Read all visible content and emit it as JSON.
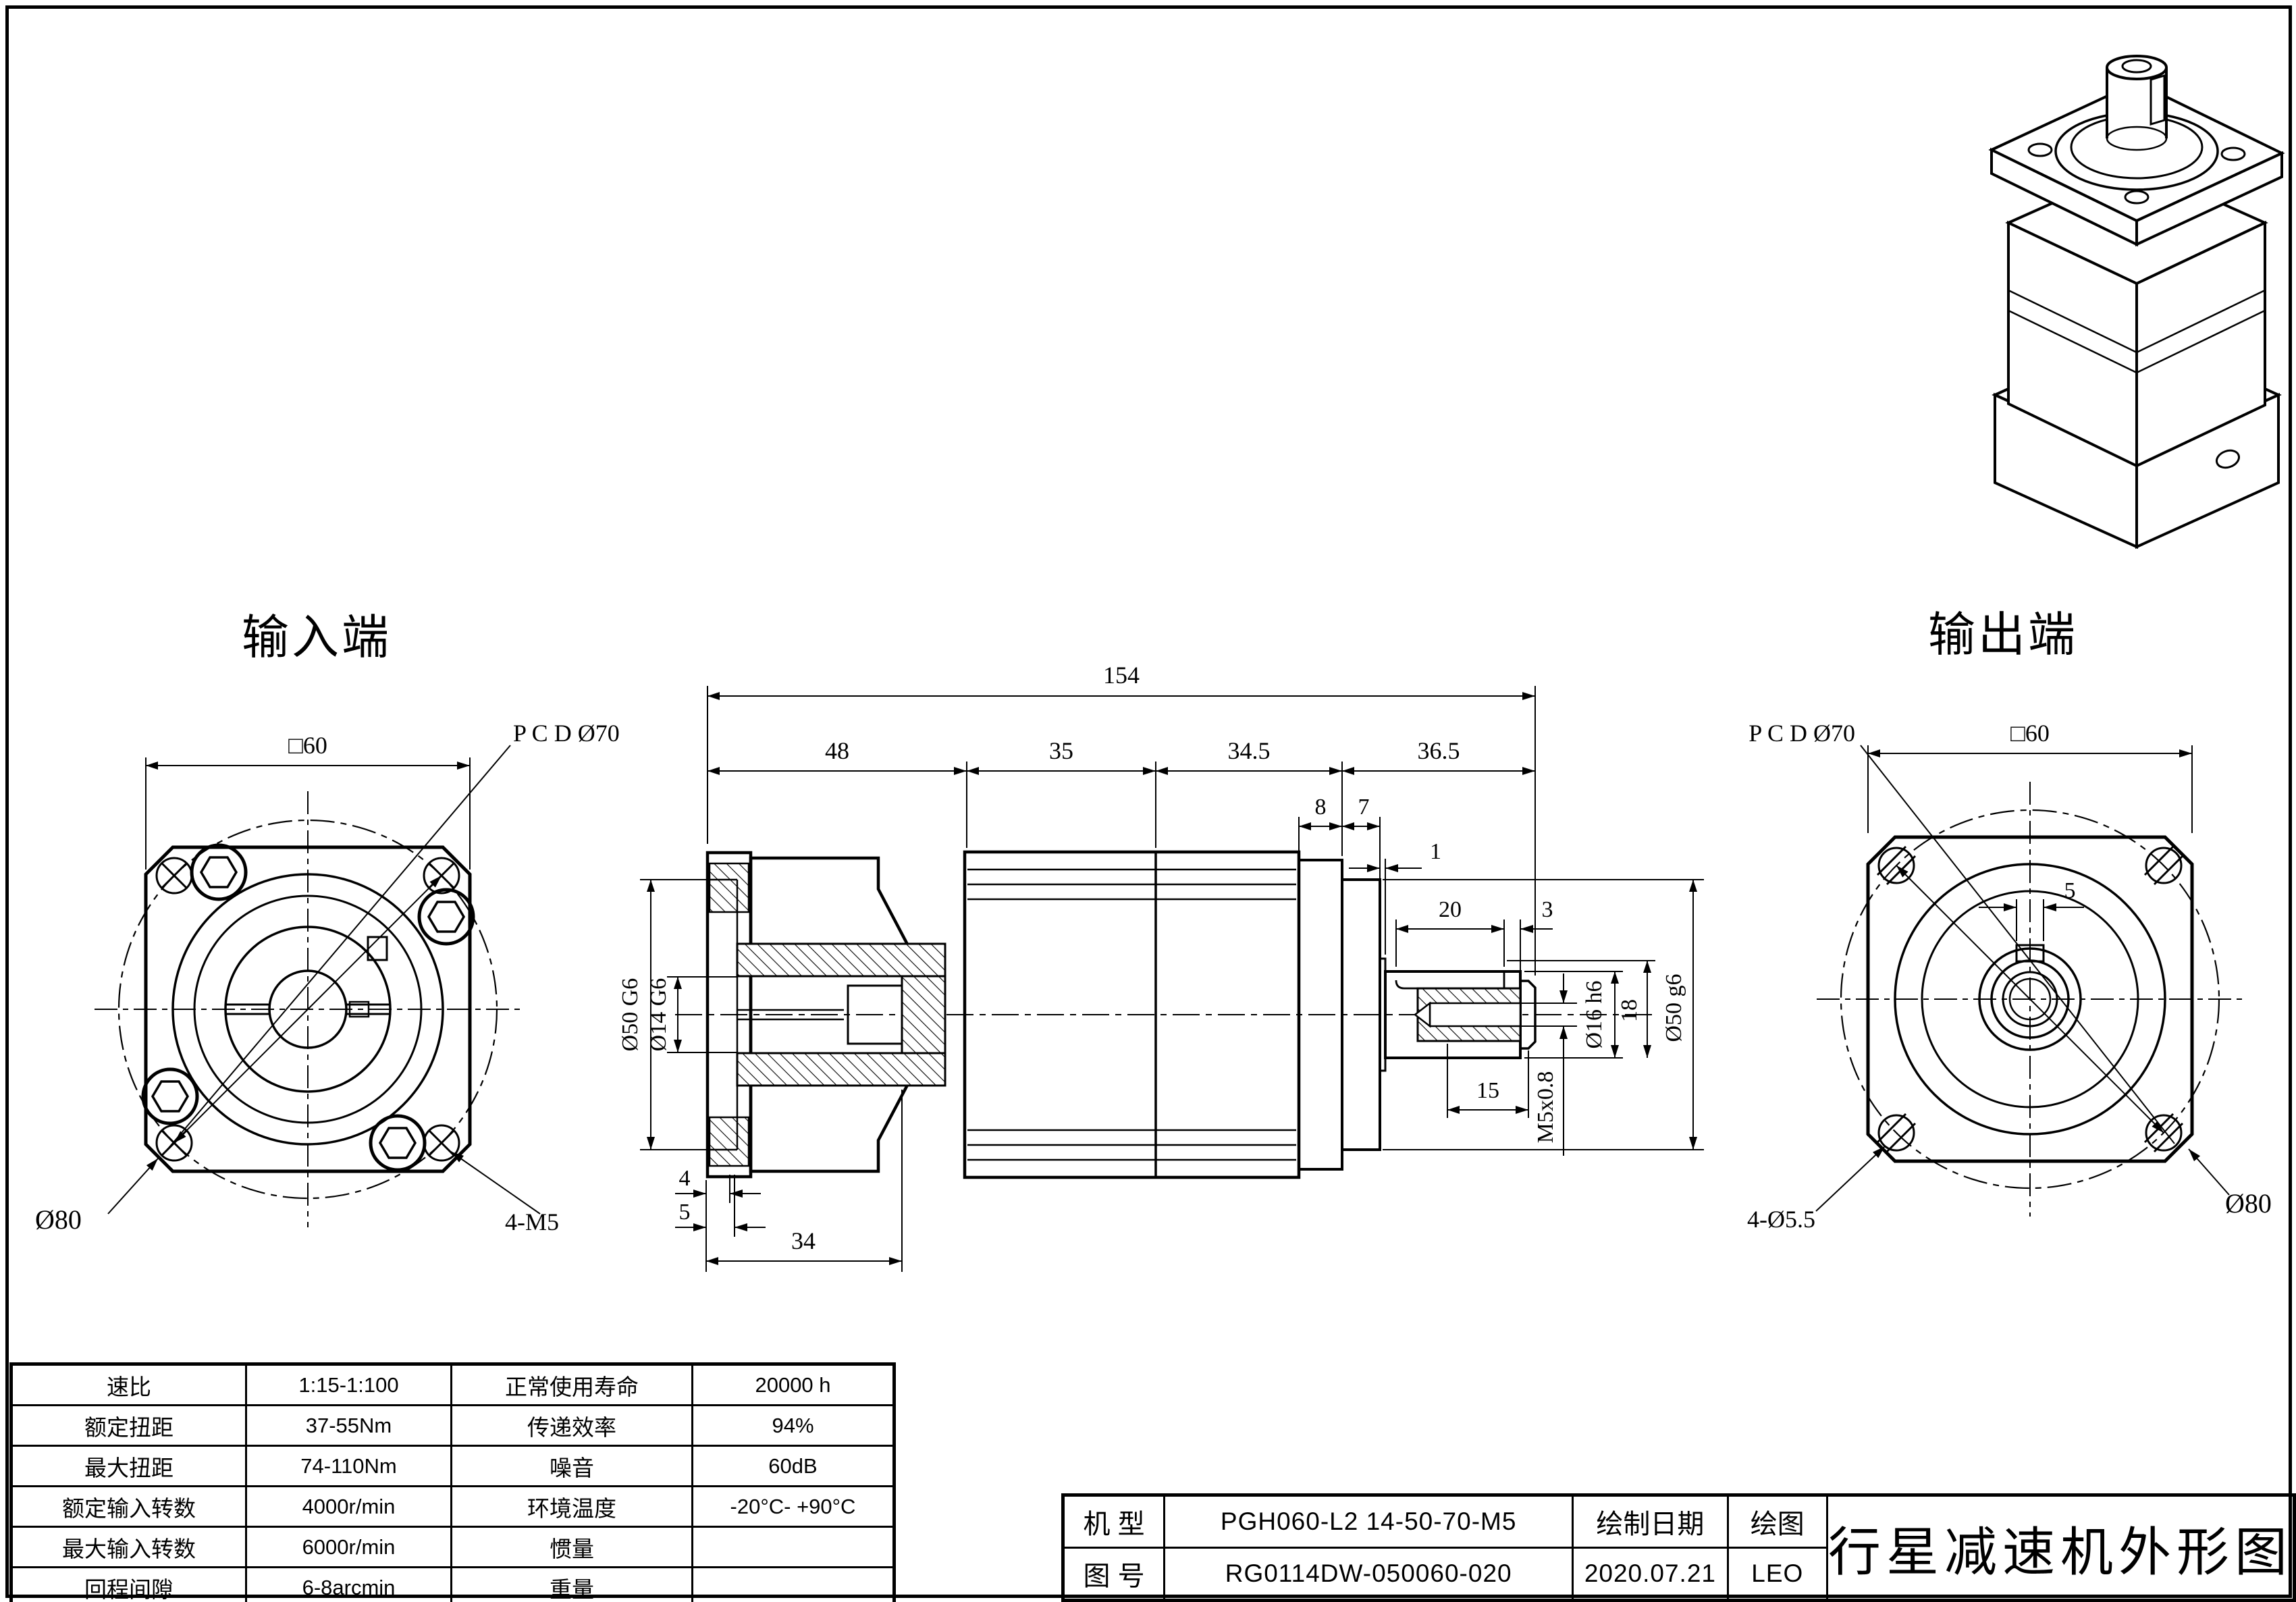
{
  "labels": {
    "input_end": "输入端",
    "output_end": "输出端"
  },
  "input_view": {
    "square": "□60",
    "pcd": "P C D Ø70",
    "outer_dia": "Ø80",
    "holes": "4-M5"
  },
  "section_view": {
    "total_len": "154",
    "seg_48": "48",
    "seg_35": "35",
    "seg_34_5": "34.5",
    "seg_36_5": "36.5",
    "d8": "8",
    "d7": "7",
    "d1": "1",
    "front_spigot": "Ø50 G6",
    "input_bore": "Ø14 G6",
    "d4": "4",
    "d5": "5",
    "d34": "34",
    "key_len": "20",
    "d3": "3",
    "thread_depth": "15",
    "thread": "M5x0.8",
    "shaft_dia": "Ø16 h6",
    "d18": "18",
    "rear_spigot": "Ø50 g6"
  },
  "output_view": {
    "square": "□60",
    "pcd": "P C D Ø70",
    "key_width": "5",
    "holes": "4-Ø5.5",
    "outer_dia": "Ø80"
  },
  "spec_table": {
    "rows": [
      {
        "c1": "速比",
        "c2": "1:15-1:100",
        "c3": "正常使用寿命",
        "c4": "20000 h"
      },
      {
        "c1": "额定扭距",
        "c2": "37-55Nm",
        "c3": "传递效率",
        "c4": "94%"
      },
      {
        "c1": "最大扭距",
        "c2": "74-110Nm",
        "c3": "噪音",
        "c4": "60dB"
      },
      {
        "c1": "额定输入转数",
        "c2": "4000r/min",
        "c3": "环境温度",
        "c4": "-20°C- +90°C"
      },
      {
        "c1": "最大输入转数",
        "c2": "6000r/min",
        "c3": "惯量",
        "c4": ""
      },
      {
        "c1": "回程间隙",
        "c2": "6-8arcmin",
        "c3": "重量",
        "c4": ""
      }
    ]
  },
  "title_block": {
    "model_label": "机 型",
    "model": "PGH060-L2 14-50-70-M5",
    "drawing_no_label": "图 号",
    "drawing_no": "RG0114DW-050060-020",
    "date_label": "绘制日期",
    "date": "2020.07.21",
    "drawn_label": "绘图",
    "drawn_by": "LEO",
    "title": "行星减速机外形图"
  }
}
